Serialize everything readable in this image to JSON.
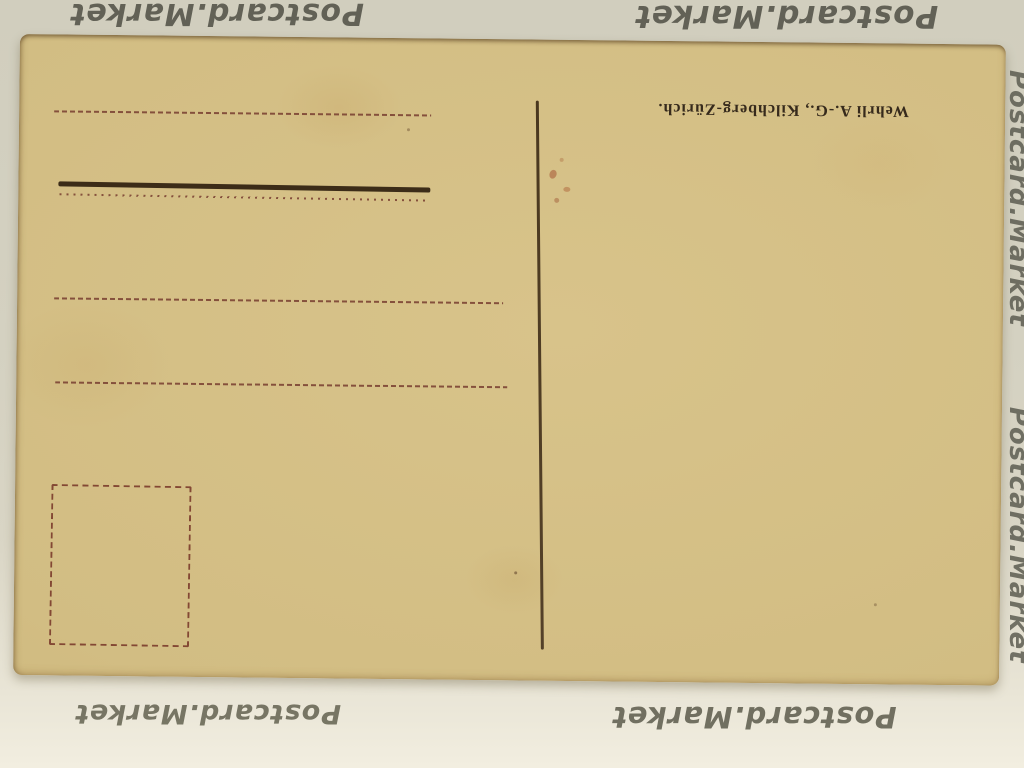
{
  "watermark": {
    "text": "Postcard.Market",
    "color": "#4f4f45"
  },
  "postcard": {
    "imprint": "Wehrli A.-G., Kilchberg-Zürich.",
    "colors": {
      "paper": "#d2bd83",
      "background_mat": "#d4d1c1",
      "ink_dark_brown": "#3c2c18",
      "ink_red_brown": "#7c4434"
    }
  }
}
